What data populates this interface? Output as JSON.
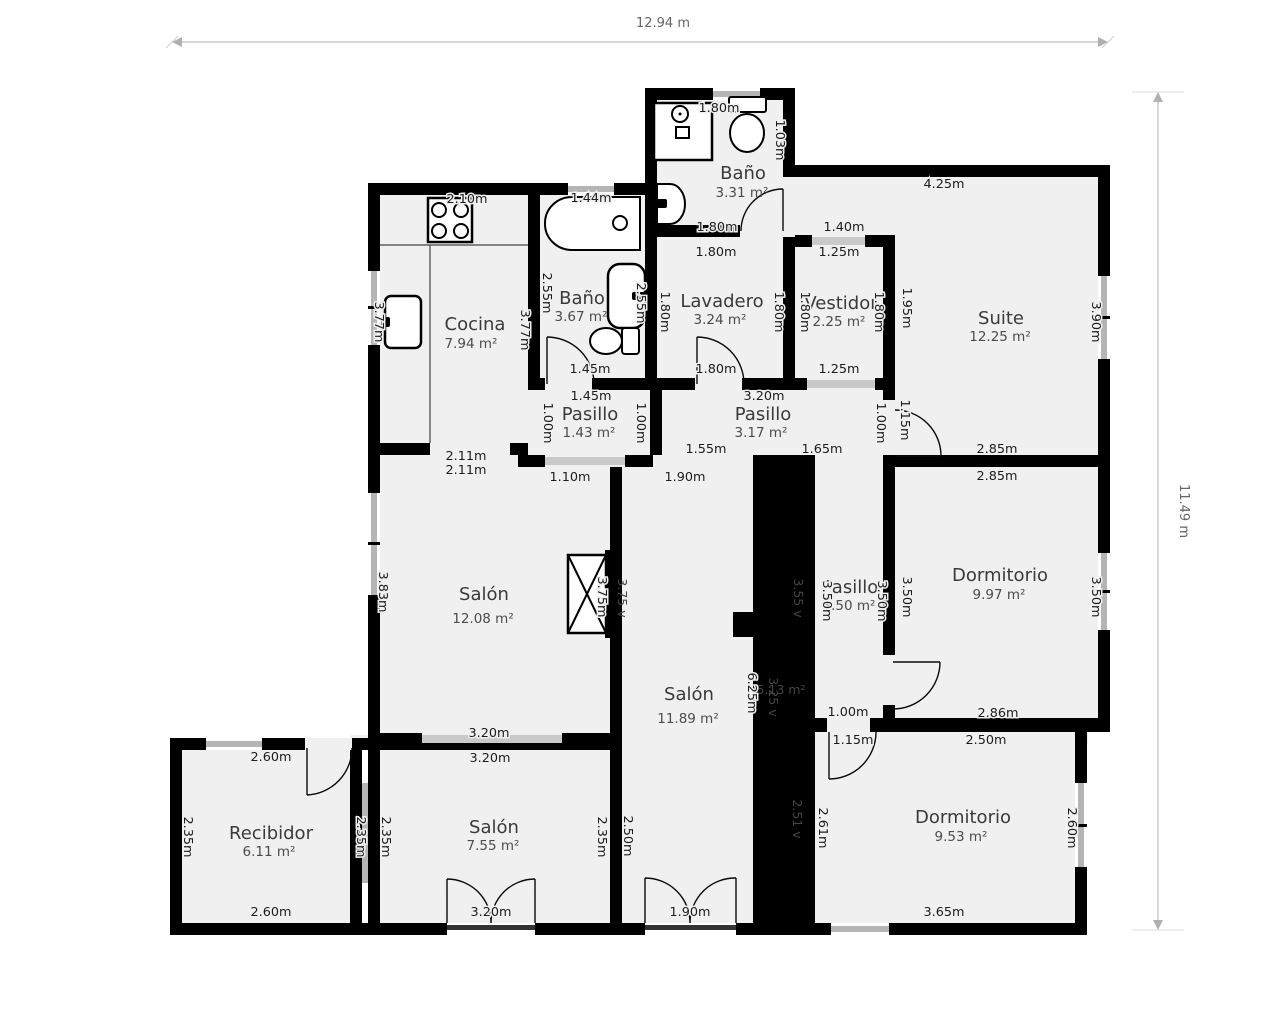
{
  "plan": {
    "width_label": "12.94 m",
    "height_label": "11.49 m"
  },
  "rooms": [
    {
      "name": "Baño",
      "area": "3.31 m²"
    },
    {
      "name": "Cocina",
      "area": "7.94 m²"
    },
    {
      "name": "Baño",
      "area": "3.67 m²"
    },
    {
      "name": "Lavadero",
      "area": "3.24 m²"
    },
    {
      "name": "Vestidor",
      "area": "2.25 m²"
    },
    {
      "name": "Suite",
      "area": "12.25 m²"
    },
    {
      "name": "Pasillo",
      "area": "1.43 m²"
    },
    {
      "name": "Pasillo",
      "area": "3.17 m²"
    },
    {
      "name": "Salón",
      "area": "12.08 m²"
    },
    {
      "name": "Salón",
      "area": "11.89 m²"
    },
    {
      "name": "Pasillo",
      "area": "3.50 m²"
    },
    {
      "name": "Dormitorio",
      "area": "9.97 m²"
    },
    {
      "name": "Recibidor",
      "area": "6.11 m²"
    },
    {
      "name": "Salón",
      "area": "7.55 m²"
    },
    {
      "name": "Dormitorio",
      "area": "9.53 m²"
    }
  ],
  "shaft": {
    "area": "5.13 m²",
    "v1": "3.55 v",
    "v2": "3.25 v",
    "v3": "2.51 v",
    "v4": "3.75 v"
  },
  "dims": [
    "1.80m",
    "1.03m",
    "1.80m",
    "1.40m",
    "1.80m",
    "1.25m",
    "2.10m",
    "3.77m",
    "3.77m",
    "1.44m",
    "2.55m",
    "2.55m",
    "1.45m",
    "1.80m",
    "1.80m",
    "1.80m",
    "1.80m",
    "1.80m",
    "1.25m",
    "1.95m",
    "4.25m",
    "3.90m",
    "2.85m",
    "1.15m",
    "1.45m",
    "1.00m",
    "1.00m",
    "3.20m",
    "1.55m",
    "1.65m",
    "1.00m",
    "1.10m",
    "1.90m",
    "2.11m",
    "2.11m",
    "3.83m",
    "3.75m",
    "3.20m",
    "3.20m",
    "6.25m",
    "2.50m",
    "1.90m",
    "3.50m",
    "3.50m",
    "3.50m",
    "2.85m",
    "3.50m",
    "2.86m",
    "1.00m",
    "1.15m",
    "2.50m",
    "2.61m",
    "2.60m",
    "3.65m",
    "2.60m",
    "2.35m",
    "2.35m",
    "2.35m",
    "2.60m",
    "2.35m",
    "3.20m"
  ]
}
